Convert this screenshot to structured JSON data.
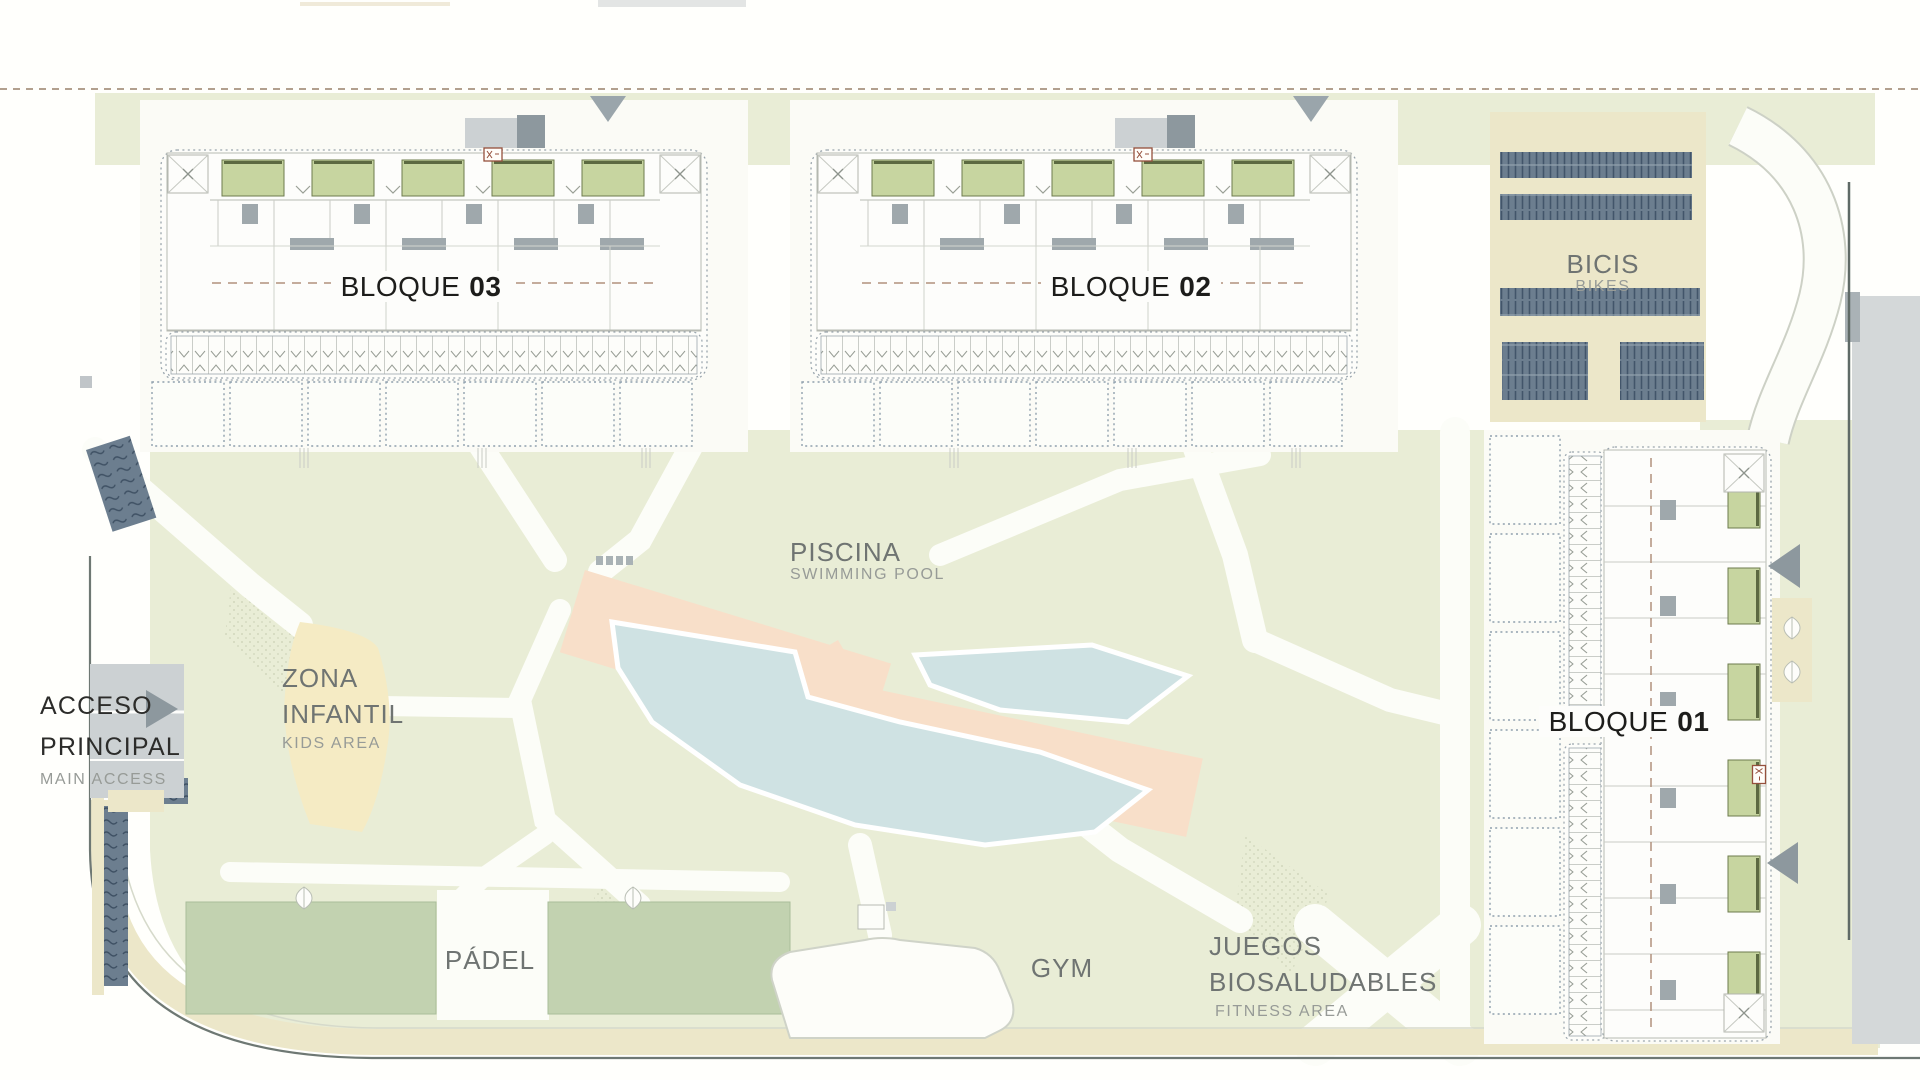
{
  "site": {
    "blocks": [
      {
        "id": "bloque-03",
        "name": "BLOQUE",
        "number": "03"
      },
      {
        "id": "bloque-02",
        "name": "BLOQUE",
        "number": "02"
      },
      {
        "id": "bloque-01",
        "name": "BLOQUE",
        "number": "01"
      }
    ],
    "areas": {
      "bikes": {
        "es": "BICIS",
        "en": "BIKES"
      },
      "pool": {
        "es": "PISCINA",
        "en": "SWIMMING POOL"
      },
      "kids": {
        "es_lines": [
          "ZONA",
          "INFANTIL"
        ],
        "en": "KIDS AREA"
      },
      "access": {
        "es_lines": [
          "ACCESO",
          "PRINCIPAL"
        ],
        "en": "MAIN ACCESS"
      },
      "padel": {
        "es": "PÁDEL"
      },
      "gym": {
        "es": "GYM"
      },
      "fitness": {
        "es_lines": [
          "JUEGOS",
          "BIOSALUDABLES"
        ],
        "en": "FITNESS AREA"
      }
    },
    "colors": {
      "lawn": "#e9edd6",
      "court": "#c2d2b0",
      "terrace": "#c7d5a0",
      "deck": "#f8dfc9",
      "water": "#cfe2e3",
      "sand": "#ece7c9",
      "kids": "#f5ebc4",
      "slate": "#6c7e8f",
      "road": "#ccd1d3",
      "road_dark": "#5f6a66",
      "outline": "#6e7873",
      "boundary_dash": "#a8937f",
      "pad": "#fbfbf6",
      "text_dark": "#1d1d1b",
      "text_gray": "#6f7472",
      "text_light": "#979b97"
    }
  }
}
